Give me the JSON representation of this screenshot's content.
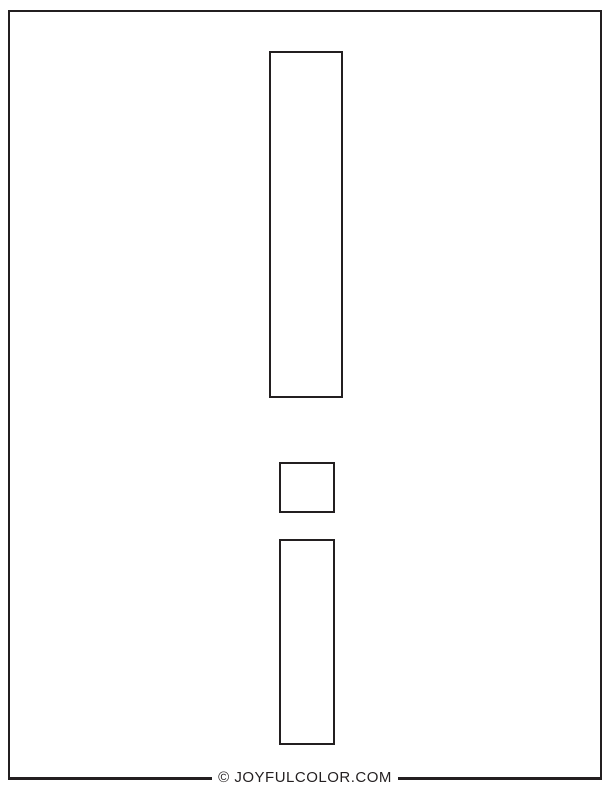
{
  "page": {
    "type": "printable coloring page",
    "background_color": "#ffffff",
    "ink_color": "#231f20"
  },
  "shapes": {
    "top_bar": "uppercase-I-outline",
    "dot": "lowercase-i-dot-outline",
    "stem": "lowercase-i-stem-outline"
  },
  "footer": {
    "credit": "© JOYFULCOLOR.COM"
  }
}
